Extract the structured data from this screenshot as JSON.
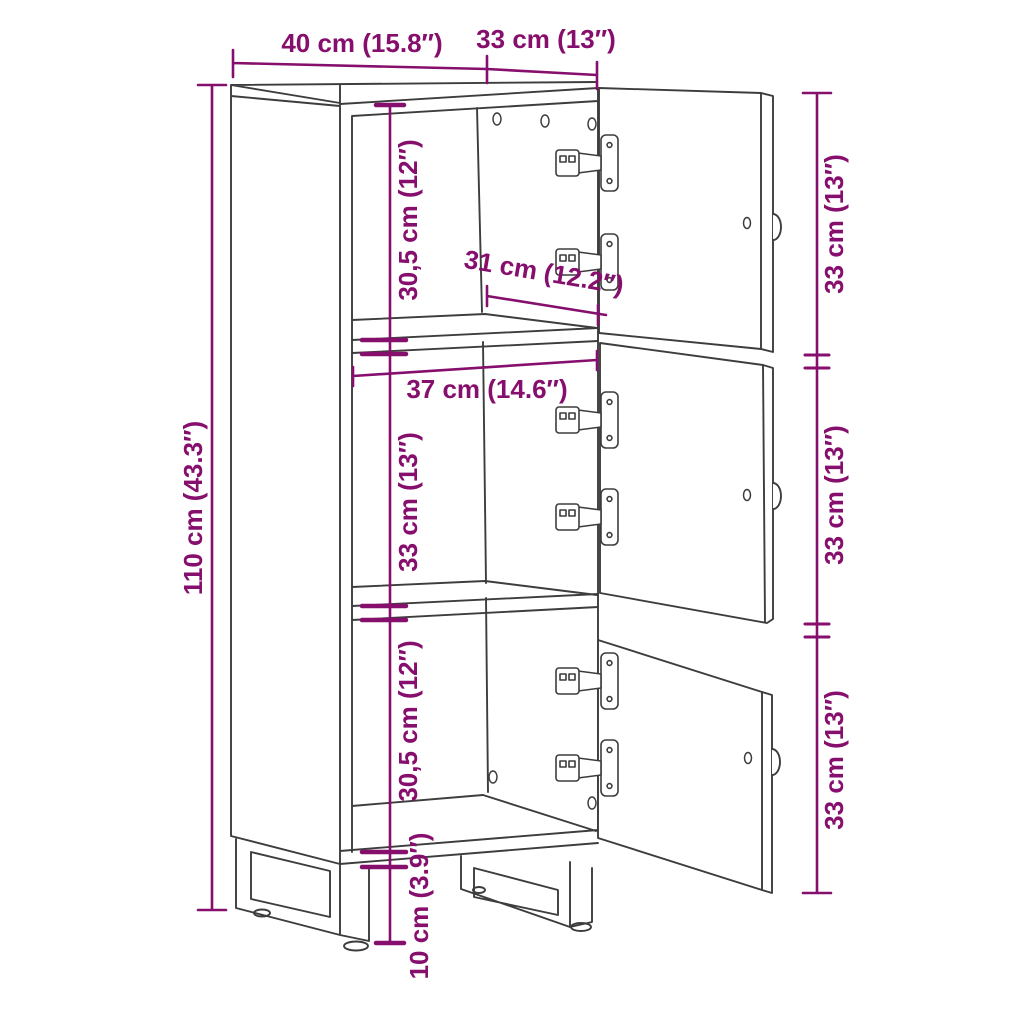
{
  "title": "Cabinet dimension diagram",
  "colors": {
    "line": "#3d3d3d",
    "dimension": "#860e6d",
    "background": "#ffffff"
  },
  "labels": {
    "width_top": "40 cm (15.8″)",
    "depth_top": "33 cm (13″)",
    "height_overall": "110 cm (43.3″)",
    "compartment_top": "30,5 cm (12″)",
    "depth_interior": "31 cm (12.2″)",
    "width_interior": "37 cm (14.6″)",
    "compartment_middle": "33 cm (13″)",
    "compartment_bottom": "30,5 cm (12″)",
    "leg_height": "10 cm (3.9″)",
    "door_top": "33 cm (13″)",
    "door_middle": "33 cm (13″)",
    "door_bottom": "33 cm (13″)"
  }
}
